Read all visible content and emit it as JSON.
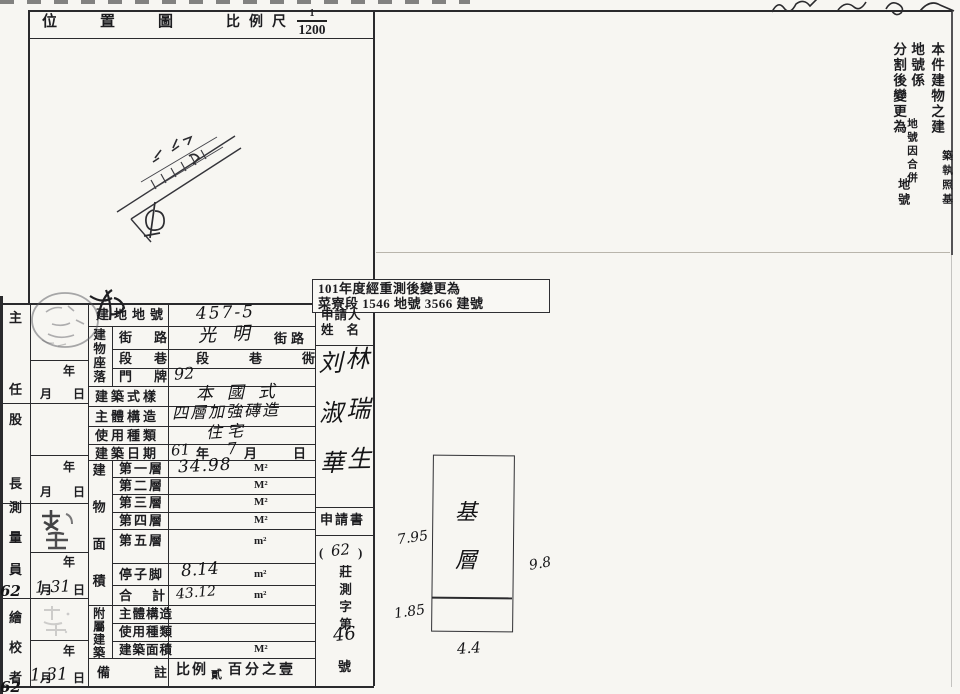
{
  "colors": {
    "paper": "#f7f6f2",
    "ink": "#1d1d20",
    "line": "#2a2a2d"
  },
  "header": {
    "title": "位置圖",
    "scale_label": "比例尺",
    "scale_numerator": "1",
    "scale_denominator": "1200"
  },
  "right_notice": {
    "col1_main": "本件建物之建",
    "col1_sub": "築執照基",
    "col2_main": "地號係",
    "col2_sub": "地號因合併",
    "col3_main": "分割後變更為",
    "col3_sub": "地號"
  },
  "remeasure_stamp": {
    "line1": "101年度經重測後變更為",
    "line2": "菜寮段 1546 地號 3566 建號"
  },
  "officials": {
    "labels": [
      "主",
      "任",
      "股",
      "長",
      "測",
      "量",
      "員",
      "繪",
      "校",
      "者"
    ],
    "year_label": "年",
    "month_label": "月",
    "day_label": "日",
    "surveyor_date": "1.31",
    "checker_date": "1.31",
    "margin_note_mid": "62",
    "margin_note_bottom": "62"
  },
  "table": {
    "lot": {
      "label": "建地地號",
      "value": "457-5"
    },
    "location_group_label": "建物座落",
    "street": {
      "label": "街路",
      "value": "光明",
      "suffix": "街路"
    },
    "section": {
      "label": "段巷",
      "printed": "段巷衖"
    },
    "house_number": {
      "label": "門牌",
      "value": "92"
    },
    "style": {
      "label": "建築式樣",
      "value": "本國式"
    },
    "structure": {
      "label": "主體構造",
      "value": "四層加強磚造"
    },
    "usage": {
      "label": "使用種類",
      "value": "住宅"
    },
    "build_date": {
      "label": "建築日期",
      "year": "61",
      "year_unit": "年",
      "month": "7",
      "month_unit": "月",
      "day_unit": "日"
    },
    "area_group_label": "建物面積",
    "floors": [
      {
        "label": "第一層",
        "value": "34.98",
        "unit": "M²"
      },
      {
        "label": "第二層",
        "value": "",
        "unit": "M²"
      },
      {
        "label": "第三層",
        "value": "",
        "unit": "M²"
      },
      {
        "label": "第四層",
        "value": "",
        "unit": "M²"
      },
      {
        "label": "第五層",
        "value": "",
        "unit": "m²"
      }
    ],
    "porch": {
      "label": "停子脚",
      "value": "8.14",
      "unit": "m²"
    },
    "total": {
      "label": "合計",
      "value": "43.12",
      "unit": "m²"
    },
    "annex_group_label": "附屬建築",
    "annex_structure_label": "主體構造",
    "annex_usage_label": "使用種類",
    "annex_area": {
      "label": "建築面積",
      "unit": "M²"
    },
    "remarks": {
      "label": "備註",
      "text_prefix": "比例",
      "text_small": "貳",
      "text_suffix": "百分之壹"
    }
  },
  "applicant": {
    "header_line1": "申請人",
    "header_line2": "姓名",
    "name_left_column": "刘淑華",
    "name_right_column": "林瑞生",
    "doc_label": "申請書",
    "paren_open": "(",
    "file_year": "62",
    "paren_close": ")",
    "file_prefix": "莊測字第",
    "file_number": "46",
    "file_suffix": "號"
  },
  "plan": {
    "room_label": "基層",
    "dim_left": "7.95",
    "dim_left_lower": "1.85",
    "dim_bottom": "4.4",
    "dim_right": "9.8"
  }
}
